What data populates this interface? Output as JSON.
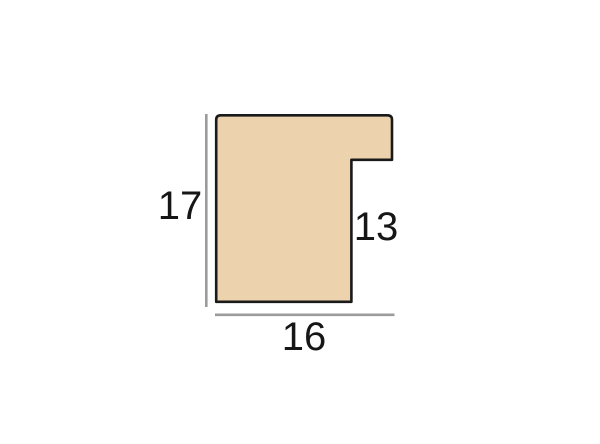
{
  "diagram": {
    "labels": {
      "height": "17",
      "rebate_depth": "13",
      "width": "16"
    },
    "colors": {
      "background": "#ffffff",
      "profile_fill": "#ecd3ae",
      "profile_outline": "#1a1a1a",
      "dimension_line": "#9b9b9b",
      "label_text": "#161616"
    }
  }
}
